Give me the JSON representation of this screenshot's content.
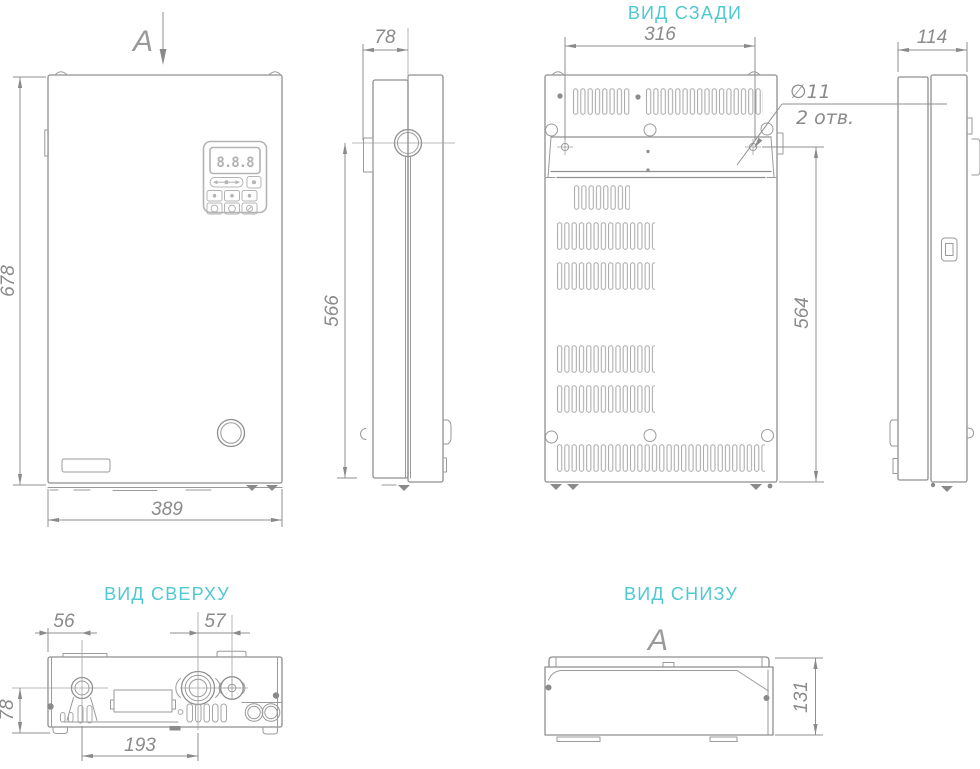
{
  "views": {
    "front": {
      "section_arrow": "A",
      "dim_height": "678",
      "dim_width": "389",
      "display": "8.8.8"
    },
    "side": {
      "dim_depth_top": "78",
      "dim_pipe_to_bottom": "566"
    },
    "rear": {
      "title": "ВИД СЗАДИ",
      "dim_hole_span": "316",
      "dim_bracket_to_bottom": "564",
      "hole_diameter": "∅11",
      "hole_count": "2 отв."
    },
    "left_side": {
      "dim_depth": "114"
    },
    "top": {
      "title": "ВИД СВЕРХУ",
      "dim_edge_to_pipe": "56",
      "dim_pipe_to_connector": "57",
      "dim_axis_to_front": "78",
      "dim_pipe_span": "193"
    },
    "bottom": {
      "title": "ВИД СНИЗУ",
      "section_arrow": "A",
      "dim_depth": "131"
    }
  },
  "colors": {
    "line": "#8f8f8f",
    "dim_text": "#8a8a8a",
    "title": "#4fc9d1",
    "background": "#ffffff"
  }
}
